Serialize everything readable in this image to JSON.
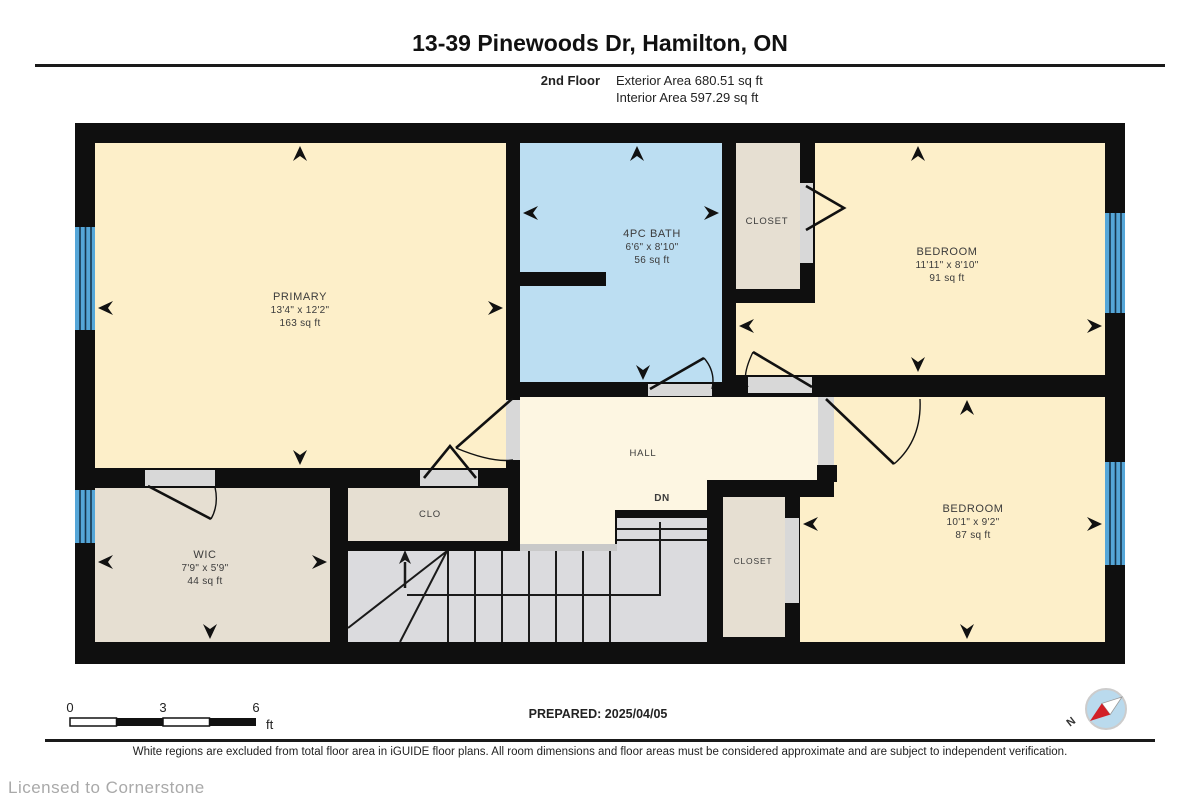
{
  "header": {
    "title": "13-39 Pinewoods Dr, Hamilton, ON",
    "floor_label": "2nd Floor",
    "exterior_area": "Exterior Area 680.51 sq ft",
    "interior_area": "Interior Area 597.29 sq ft"
  },
  "rooms": {
    "primary": {
      "name": "PRIMARY",
      "dims": "13'4\" x 12'2\"",
      "area": "163 sq ft"
    },
    "bath": {
      "name": "4PC BATH",
      "dims": "6'6\" x 8'10\"",
      "area": "56 sq ft"
    },
    "bedroom1": {
      "name": "BEDROOM",
      "dims": "11'11\" x 8'10\"",
      "area": "91 sq ft"
    },
    "bedroom2": {
      "name": "BEDROOM",
      "dims": "10'1\" x 9'2\"",
      "area": "87 sq ft"
    },
    "wic": {
      "name": "WIC",
      "dims": "7'9\" x 5'9\"",
      "area": "44 sq ft"
    },
    "hall": {
      "name": "HALL"
    },
    "stairs": {
      "name": "DN"
    },
    "clo": {
      "name": "CLO"
    },
    "closet_top": {
      "name": "CLOSET"
    },
    "closet_bottom": {
      "name": "CLOSET"
    }
  },
  "scale_bar": {
    "tick0": "0",
    "tick1": "3",
    "tick2": "6",
    "unit": "ft"
  },
  "compass": {
    "north_label": "N"
  },
  "footer": {
    "prepared": "PREPARED: 2025/04/05",
    "disclaimer": "White regions are excluded from total floor area in iGUIDE floor plans. All room dimensions and floor areas must be considered approximate and are subject to independent verification.",
    "license": "Licensed to Cornerstone"
  },
  "colors": {
    "wall": "#0f0f0f",
    "room_cream": "#fdefc9",
    "hall_cream": "#fdf6e2",
    "bath_blue": "#bcdef2",
    "closet_tan": "#e6dfd2",
    "stairs_gray": "#dbdbde",
    "window_blue": "#55a6d8",
    "jamb_gray": "#d8d8d8",
    "compass_red": "#d22027"
  }
}
